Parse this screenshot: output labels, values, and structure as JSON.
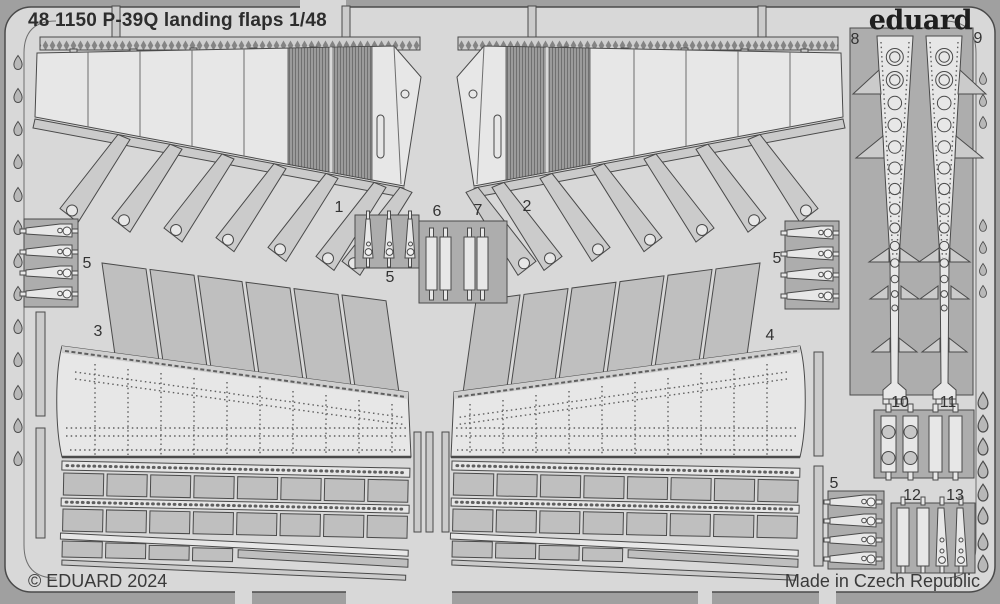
{
  "header": {
    "title": "48 1150 P-39Q landing flaps 1/48",
    "brand": "eduard"
  },
  "footer": {
    "copyright": "© EDUARD 2024",
    "made_in": "Made in Czech Republic"
  },
  "labels": {
    "p1": "1",
    "p2": "2",
    "p3": "3",
    "p4": "4",
    "p5_left": "5",
    "p5_center": "5",
    "p5_right": "5",
    "p5_bottom": "5",
    "p6": "6",
    "p7": "7",
    "p8": "8",
    "p9": "9",
    "p10": "10",
    "p11": "11",
    "p12": "12",
    "p13": "13"
  },
  "colors": {
    "background": "#a0a0a0",
    "sheet": "#d8d8d8",
    "part_light": "#e7e7e7",
    "part_mid": "#cbcbcb",
    "panel": "#bfbfbf",
    "window": "#adadad",
    "outline": "#4a4a4a",
    "line": "#6e6e6e",
    "rivet": "#5f5f5f",
    "text": "#333333",
    "drop": "#b8b8b8"
  }
}
